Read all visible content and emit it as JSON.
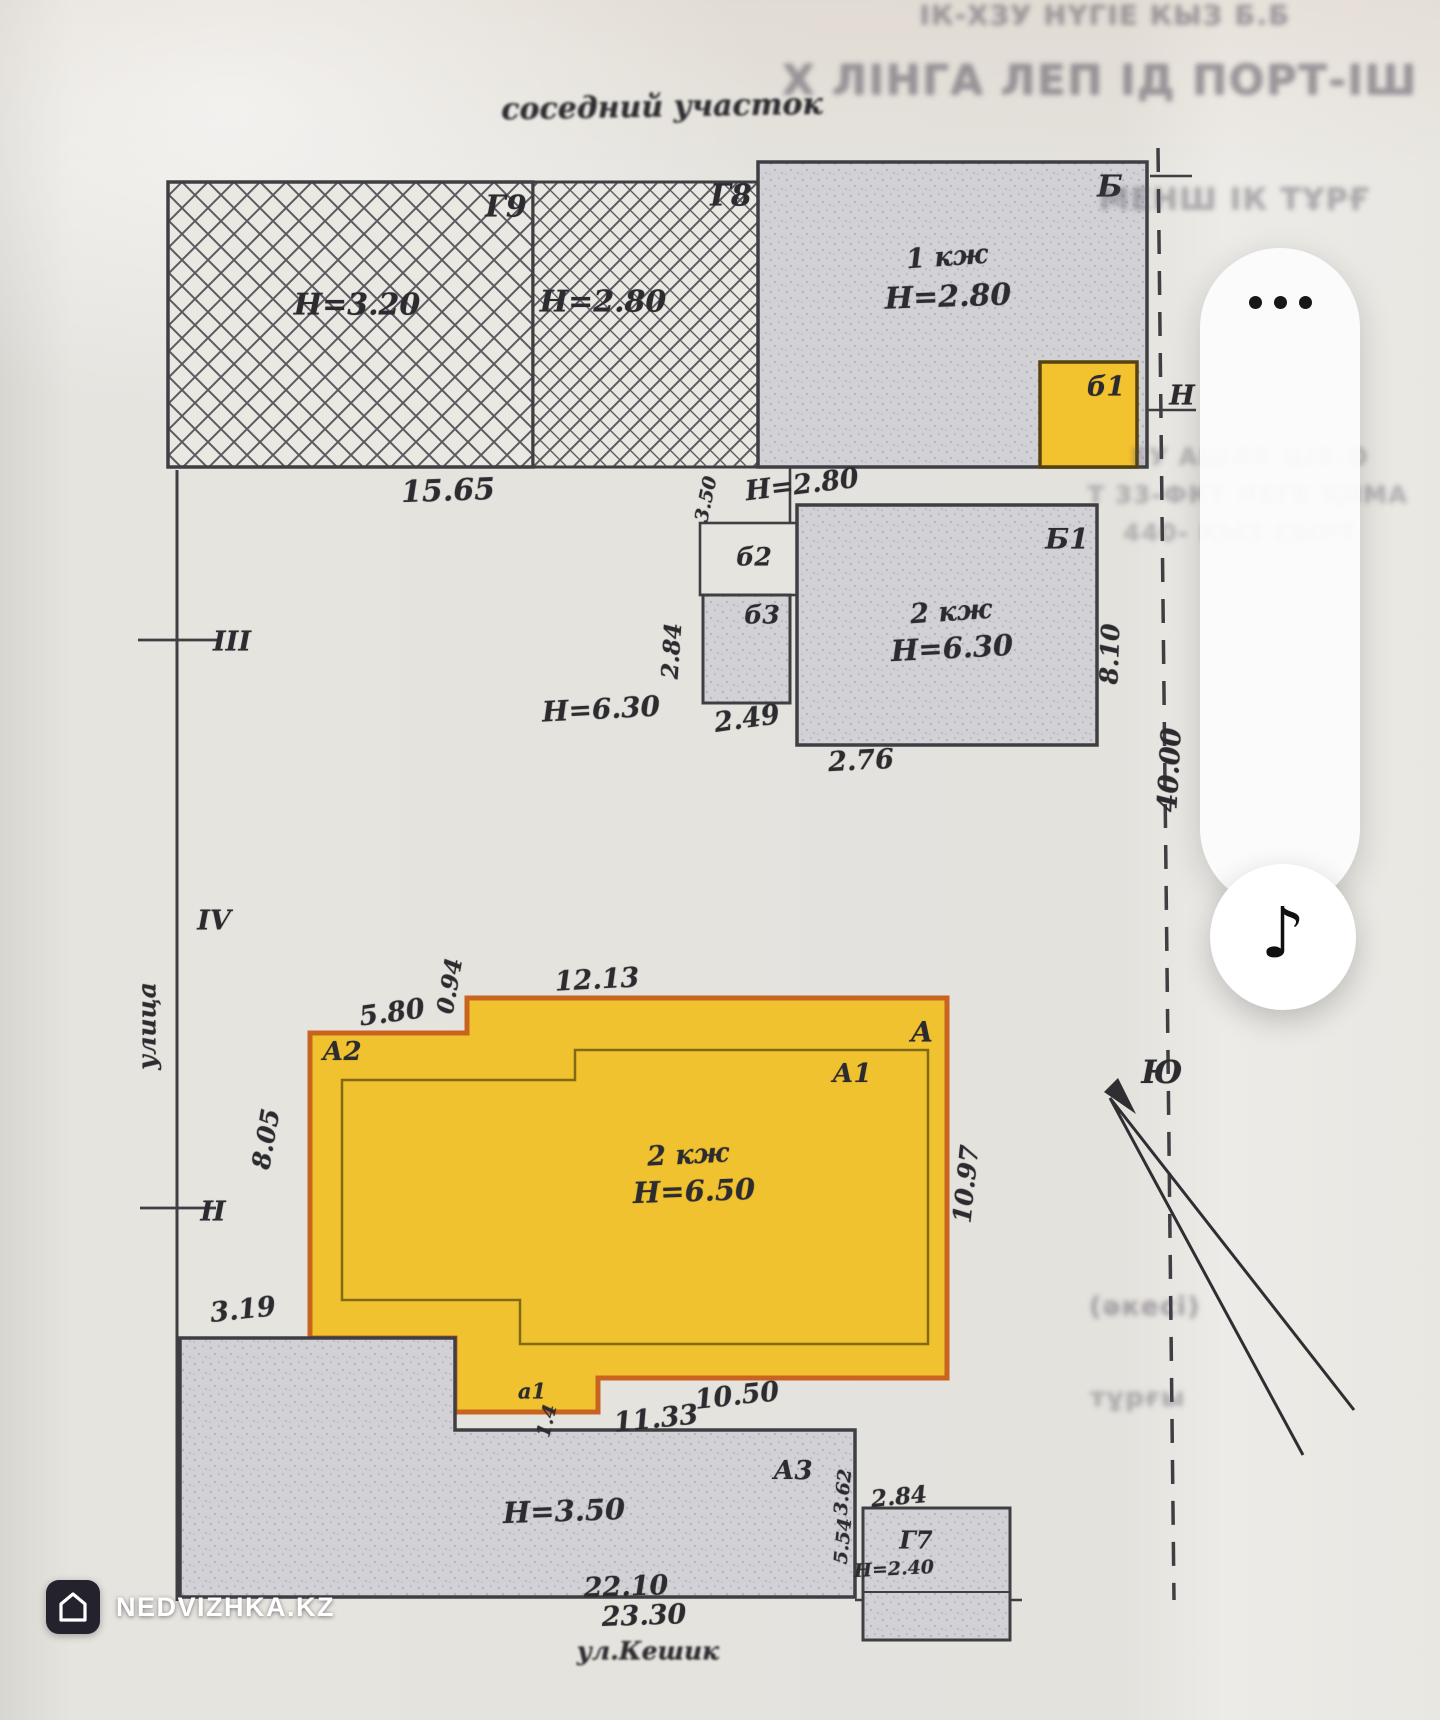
{
  "app": {
    "watermark": {
      "brand": "NEDVIZHKA.KZ"
    },
    "overlay": {
      "music_icon": "♪"
    }
  },
  "plan": {
    "labels": [
      {
        "n": "neighbor-plot-label",
        "t": "соседний участок",
        "x": 662,
        "y": 107,
        "s": 30,
        "r": -1,
        "b": 1.4
      },
      {
        "n": "building-label-g9",
        "t": "Г9",
        "x": 506,
        "y": 207,
        "s": 30
      },
      {
        "n": "height-label",
        "t": "Н=3.20",
        "x": 357,
        "y": 305,
        "s": 30
      },
      {
        "n": "building-label-g8",
        "t": "Г8",
        "x": 731,
        "y": 196,
        "s": 30
      },
      {
        "n": "height-label",
        "t": "Н=2.80",
        "x": 603,
        "y": 302,
        "s": 30
      },
      {
        "n": "building-label-b",
        "t": "Б",
        "x": 1110,
        "y": 187,
        "s": 30
      },
      {
        "n": "storey-label",
        "t": "1 кж",
        "x": 947,
        "y": 257,
        "s": 27,
        "r": -4
      },
      {
        "n": "height-label",
        "t": "Н=2.80",
        "x": 948,
        "y": 297,
        "s": 30,
        "r": -2
      },
      {
        "n": "building-label-b1-small",
        "t": "б1",
        "x": 1106,
        "y": 387,
        "s": 27
      },
      {
        "n": "height-label",
        "t": "Н",
        "x": 1182,
        "y": 396,
        "s": 27
      },
      {
        "n": "dim-label",
        "t": "15.65",
        "x": 448,
        "y": 491,
        "s": 30,
        "r": -2
      },
      {
        "n": "dim-label",
        "t": "3.50",
        "x": 706,
        "y": 499,
        "s": 19,
        "r": -78
      },
      {
        "n": "height-label",
        "t": "Н=2.80",
        "x": 802,
        "y": 485,
        "s": 27,
        "r": -7
      },
      {
        "n": "building-label-b2-small",
        "t": "б2",
        "x": 754,
        "y": 557,
        "s": 25
      },
      {
        "n": "building-label-b3-small",
        "t": "б3",
        "x": 762,
        "y": 615,
        "s": 25
      },
      {
        "n": "dim-label",
        "t": "2.84",
        "x": 672,
        "y": 651,
        "s": 23,
        "r": -86
      },
      {
        "n": "height-label",
        "t": "Н=6.30",
        "x": 601,
        "y": 709,
        "s": 28,
        "r": -3
      },
      {
        "n": "dim-label",
        "t": "2.49",
        "x": 747,
        "y": 719,
        "s": 27,
        "r": -8
      },
      {
        "n": "building-label-b1",
        "t": "Б1",
        "x": 1067,
        "y": 539,
        "s": 28
      },
      {
        "n": "storey-label",
        "t": "2 кж",
        "x": 951,
        "y": 612,
        "s": 27,
        "r": -4
      },
      {
        "n": "height-label",
        "t": "Н=6.30",
        "x": 952,
        "y": 648,
        "s": 29,
        "r": -3
      },
      {
        "n": "dim-label",
        "t": "2.76",
        "x": 861,
        "y": 761,
        "s": 27,
        "r": -3
      },
      {
        "n": "dim-label",
        "t": "8.10",
        "x": 1110,
        "y": 654,
        "s": 25,
        "r": -88
      },
      {
        "n": "dim-label",
        "t": "40.00",
        "x": 1170,
        "y": 770,
        "s": 27,
        "r": -87
      },
      {
        "n": "boundary-point",
        "t": "III",
        "x": 232,
        "y": 642,
        "s": 27
      },
      {
        "n": "boundary-point",
        "t": "IV",
        "x": 214,
        "y": 921,
        "s": 27
      },
      {
        "n": "street-label-left",
        "t": "улица",
        "x": 147,
        "y": 1026,
        "s": 25,
        "r": -90
      },
      {
        "n": "boundary-point",
        "t": "II",
        "x": 213,
        "y": 1212,
        "s": 27
      },
      {
        "n": "dim-label",
        "t": "5.80",
        "x": 392,
        "y": 1013,
        "s": 27,
        "r": -8
      },
      {
        "n": "dim-label",
        "t": "0.94",
        "x": 450,
        "y": 986,
        "s": 23,
        "r": -80
      },
      {
        "n": "dim-label",
        "t": "12.13",
        "x": 597,
        "y": 980,
        "s": 27,
        "r": -3
      },
      {
        "n": "building-label-a2",
        "t": "А2",
        "x": 342,
        "y": 1052,
        "s": 26
      },
      {
        "n": "building-label-a",
        "t": "А",
        "x": 922,
        "y": 1032,
        "s": 28
      },
      {
        "n": "building-label-a1",
        "t": "А1",
        "x": 852,
        "y": 1074,
        "s": 26
      },
      {
        "n": "storey-label",
        "t": "2 кж",
        "x": 688,
        "y": 1155,
        "s": 27,
        "r": -3
      },
      {
        "n": "height-label",
        "t": "Н=6.50",
        "x": 694,
        "y": 1191,
        "s": 29,
        "r": -2
      },
      {
        "n": "dim-label",
        "t": "8.05",
        "x": 266,
        "y": 1139,
        "s": 25,
        "r": -80
      },
      {
        "n": "dim-label",
        "t": "10.97",
        "x": 966,
        "y": 1184,
        "s": 25,
        "r": -84
      },
      {
        "n": "dim-label",
        "t": "3.19",
        "x": 243,
        "y": 1310,
        "s": 27,
        "r": -6
      },
      {
        "n": "building-label-a1-small",
        "t": "а1",
        "x": 532,
        "y": 1391,
        "s": 21
      },
      {
        "n": "dim-label",
        "t": "1.4",
        "x": 547,
        "y": 1421,
        "s": 19,
        "r": -76
      },
      {
        "n": "dim-label",
        "t": "10.50",
        "x": 737,
        "y": 1396,
        "s": 27,
        "r": -6
      },
      {
        "n": "dim-label",
        "t": "11.33",
        "x": 656,
        "y": 1419,
        "s": 27,
        "r": -6
      },
      {
        "n": "building-label-a3",
        "t": "А3",
        "x": 793,
        "y": 1471,
        "s": 26
      },
      {
        "n": "height-label",
        "t": "Н=3.50",
        "x": 564,
        "y": 1511,
        "s": 29,
        "r": -2
      },
      {
        "n": "dim-label",
        "t": "3.62",
        "x": 843,
        "y": 1492,
        "s": 19,
        "r": -84
      },
      {
        "n": "dim-label",
        "t": "5.54",
        "x": 843,
        "y": 1541,
        "s": 19,
        "r": -84
      },
      {
        "n": "dim-label",
        "t": "2.84",
        "x": 899,
        "y": 1497,
        "s": 23,
        "r": -5
      },
      {
        "n": "building-label-g7",
        "t": "Г7",
        "x": 916,
        "y": 1540,
        "s": 24
      },
      {
        "n": "height-label",
        "t": "Н=2.40",
        "x": 894,
        "y": 1569,
        "s": 19,
        "r": -3
      },
      {
        "n": "dim-label",
        "t": "22.10",
        "x": 626,
        "y": 1587,
        "s": 27,
        "r": -2
      },
      {
        "n": "dim-label",
        "t": "23.30",
        "x": 644,
        "y": 1616,
        "s": 27,
        "r": -2
      },
      {
        "n": "street-label-bottom",
        "t": "ул.Кешик",
        "x": 648,
        "y": 1651,
        "s": 25,
        "b": 1.1
      },
      {
        "n": "south-mark",
        "t": "Ю",
        "x": 1162,
        "y": 1072,
        "s": 32
      }
    ]
  },
  "artifacts": [
    {
      "t": "ІК-ХЗУ НҮГІЕ КЫЗ Б.Б",
      "x": 1105,
      "y": 16,
      "s": 27,
      "o": 0.45
    },
    {
      "t": "Х ЛІНГА ЛЕП ІД ПОРТ-ІШ",
      "x": 1100,
      "y": 80,
      "s": 42,
      "o": 0.5
    },
    {
      "t": "МЕНШ ІК ТҰРҒ",
      "x": 1235,
      "y": 200,
      "s": 30,
      "o": 0.38
    },
    {
      "t": "ЕУ АШЛЯ ЦІЯ-О",
      "x": 1250,
      "y": 457,
      "s": 24,
      "o": 0.3
    },
    {
      "t": "Т 33-ФКТ НЕГЕ ҚИМА",
      "x": 1248,
      "y": 495,
      "s": 24,
      "o": 0.32
    },
    {
      "t": "440- ҚЫЗ СЫРТ",
      "x": 1240,
      "y": 533,
      "s": 24,
      "o": 0.3
    },
    {
      "t": "(әкесі)",
      "x": 1145,
      "y": 1307,
      "s": 26,
      "o": 0.4
    },
    {
      "t": "тұрғы",
      "x": 1138,
      "y": 1398,
      "s": 26,
      "o": 0.35
    }
  ]
}
